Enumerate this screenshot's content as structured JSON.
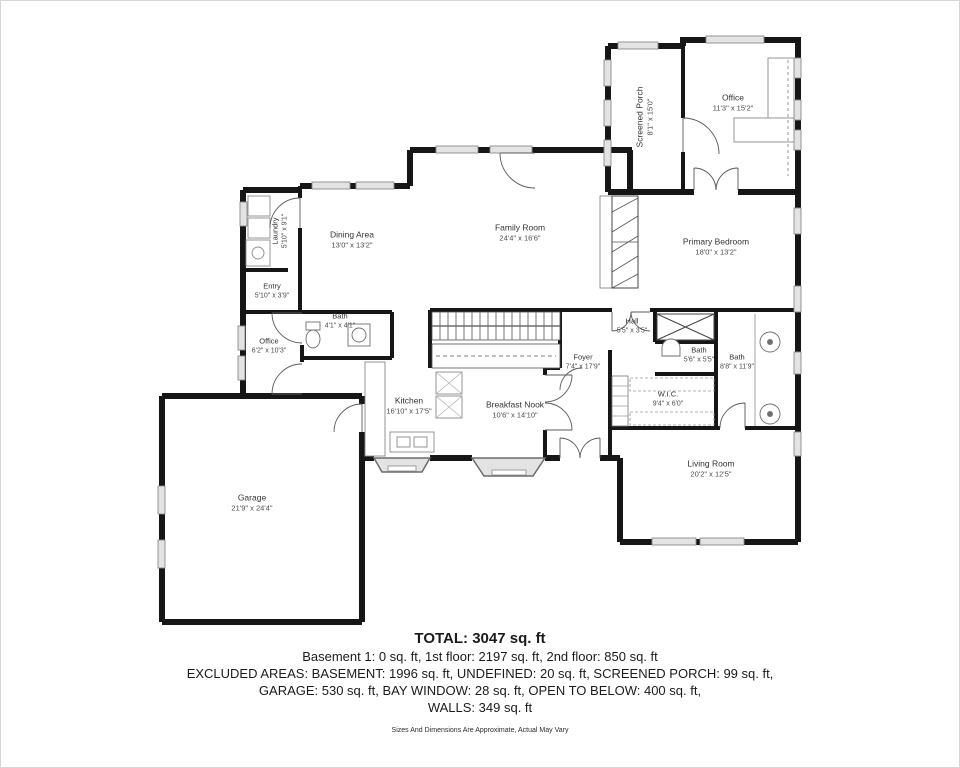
{
  "rooms": [
    {
      "label": "Screened Porch",
      "dims": "8'1\" x 15'0\""
    },
    {
      "label": "Office",
      "dims": "11'3\" x 15'2\""
    },
    {
      "label": "Family Room",
      "dims": "24'4\" x 16'6\""
    },
    {
      "label": "Dining Area",
      "dims": "13'0\" x 13'2\""
    },
    {
      "label": "Laundry",
      "dims": "5'10\" x 9'1\""
    },
    {
      "label": "Entry",
      "dims": "5'10\" x 3'9\""
    },
    {
      "label": "Primary Bedroom",
      "dims": "18'0\" x 13'2\""
    },
    {
      "label": "Office",
      "dims": "6'2\" x 10'3\""
    },
    {
      "label": "Bath",
      "dims": "4'1\" x 4'1\""
    },
    {
      "label": "Kitchen",
      "dims": "16'10\" x 17'5\""
    },
    {
      "label": "Breakfast Nook",
      "dims": "10'6\" x 14'10\""
    },
    {
      "label": "Foyer",
      "dims": "7'4\" x 17'9\""
    },
    {
      "label": "Hall",
      "dims": "5'5\" x 3'5\""
    },
    {
      "label": "Bath",
      "dims": "5'6\" x 5'5\""
    },
    {
      "label": "W.I.C.",
      "dims": "9'4\" x 6'0\""
    },
    {
      "label": "Bath",
      "dims": "8'8\" x 11'9\""
    },
    {
      "label": "Living Room",
      "dims": "20'2\" x 12'5\""
    },
    {
      "label": "Garage",
      "dims": "21'9\" x 24'4\""
    }
  ],
  "summary": {
    "total": "TOTAL: 3047 sq. ft",
    "floors": "Basement 1: 0 sq. ft, 1st floor: 2197 sq. ft, 2nd floor: 850 sq. ft",
    "excluded1": "EXCLUDED AREAS: BASEMENT: 1996 sq. ft, UNDEFINED: 20 sq. ft, SCREENED PORCH: 99 sq. ft,",
    "excluded2": "GARAGE: 530 sq. ft, BAY WINDOW: 28 sq. ft, OPEN TO BELOW: 400 sq. ft,",
    "excluded3": "WALLS: 349 sq. ft",
    "disclaimer": "Sizes And Dimensions Are Approximate, Actual May Vary"
  },
  "colors": {
    "wall": "#161616",
    "window_fill": "#e3e3e3",
    "window_stroke": "#8a8a8a",
    "text": "#1b1b1b"
  }
}
